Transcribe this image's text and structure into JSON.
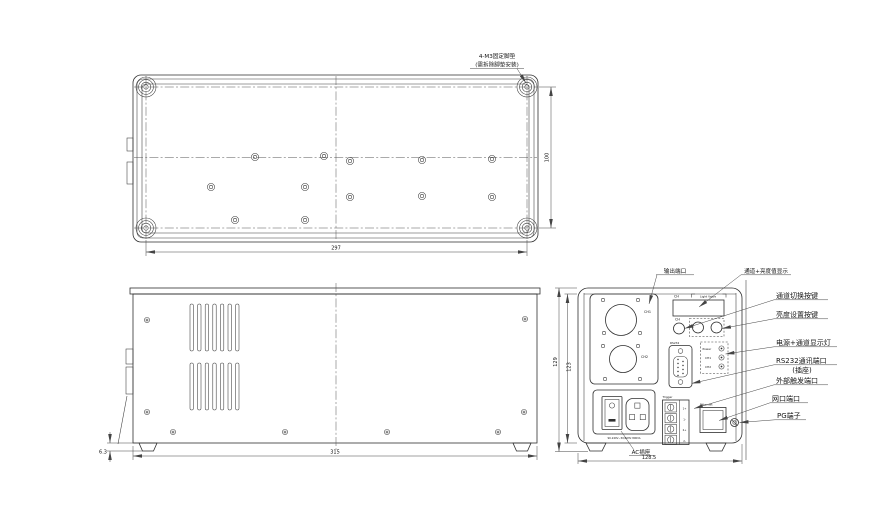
{
  "annotations": {
    "foot_line1": "4-M3固定脚垫",
    "foot_line2": "(需拆除脚垫安装)"
  },
  "top_view": {
    "width": "297",
    "height": "100"
  },
  "side_view": {
    "width": "315",
    "foot_height": "6.3"
  },
  "rear_view": {
    "width": "128.5",
    "height_outer": "129",
    "height_inner": "123",
    "ch1": "CH1",
    "ch2": "CH2",
    "display_ch": "CH",
    "display_value": "Light Value",
    "button_ch": "CH",
    "rs232": "RS232",
    "indicator_power": "Power",
    "indicator_ch1": "CH1",
    "indicator_ch2": "CH2",
    "trigger": "Trigger",
    "trigger_pins": [
      "1+",
      "1-",
      "2+",
      "2-"
    ],
    "ethernet": "Ethernet",
    "ac_marking": "90-240V~50/60Hz 800VA"
  },
  "callouts": {
    "output_port": "输出端口",
    "display": "通道+亮度值显示",
    "channel_switch": "通道切换按键",
    "brightness_set": "亮度设置按键",
    "power_channel_leds": "电源+通道显示灯",
    "rs232_port": "RS232通讯端口",
    "rs232_sub": "(插座)",
    "ext_trigger": "外部触发端口",
    "lan_port": "网口端口",
    "pg_terminal": "PG端子",
    "ac_socket": "AC插座"
  }
}
